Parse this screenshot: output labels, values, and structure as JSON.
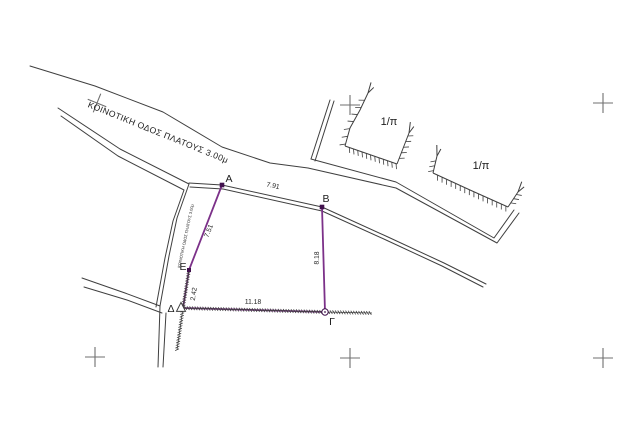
{
  "canvas": {
    "width": 640,
    "height": 429,
    "background": "#ffffff"
  },
  "colors": {
    "line": "#3f3f3f",
    "purple": "#7c3189",
    "marker": "#41124d",
    "grid": "#6f6f6f",
    "text": "#1c1c1c"
  },
  "parcel": {
    "vertex_labels": [
      "Α",
      "Β",
      "Γ",
      "Δ",
      "Ε"
    ],
    "side_lengths": {
      "ΑΒ": "7.91",
      "ΒΓ": "8.18",
      "ΓΔ": "11.18",
      "ΔΕ": "2.42",
      "ΕΑ": "7.51"
    },
    "road_name": "ΚΟΙΝΟΤΙΚΗ ΟΔΟΣ ΠΛΑΤΟΥΣ 3.00μ",
    "adjacent_parcel_label": "1/π"
  },
  "plan": {
    "crosshairs": [
      {
        "x": 97,
        "y": 103,
        "rotate": 22
      },
      {
        "x": 350,
        "y": 105,
        "rotate": 0
      },
      {
        "x": 603,
        "y": 103,
        "rotate": 0
      },
      {
        "x": 95,
        "y": 357,
        "rotate": 0
      },
      {
        "x": 350,
        "y": 358,
        "rotate": 0
      },
      {
        "x": 603,
        "y": 358,
        "rotate": 0
      }
    ],
    "polylines": [
      {
        "name": "top-road-upper-edge",
        "color": "line",
        "width": 1,
        "points": [
          [
            30,
            66
          ],
          [
            95,
            86
          ],
          [
            163,
            112
          ],
          [
            222,
            147
          ],
          [
            270,
            163
          ],
          [
            308,
            168
          ]
        ]
      },
      {
        "name": "neighbor-wall-bottom-outer",
        "color": "line",
        "width": 1,
        "points": [
          [
            308,
            168
          ],
          [
            396,
            188
          ],
          [
            497,
            243
          ],
          [
            519,
            213
          ]
        ]
      },
      {
        "name": "neighbor-wall-bottom-inner",
        "color": "line",
        "width": 1,
        "points": [
          [
            311,
            159
          ],
          [
            396,
            182
          ],
          [
            494,
            238
          ],
          [
            514,
            210
          ]
        ]
      },
      {
        "name": "neighbor-wall-left-a",
        "color": "line",
        "width": 1,
        "points": [
          [
            330,
            100
          ],
          [
            311,
            159
          ]
        ]
      },
      {
        "name": "neighbor-wall-left-b",
        "color": "line",
        "width": 1,
        "points": [
          [
            334,
            101
          ],
          [
            315,
            161
          ]
        ]
      },
      {
        "name": "road-edge-through-AB-a",
        "color": "line",
        "width": 1,
        "points": [
          [
            189,
            183
          ],
          [
            222,
            185
          ],
          [
            322,
            207
          ],
          [
            388,
            237
          ],
          [
            444,
            263
          ],
          [
            486,
            284
          ]
        ]
      },
      {
        "name": "road-edge-through-AB-b",
        "color": "line",
        "width": 1,
        "points": [
          [
            190,
            187
          ],
          [
            223,
            189
          ],
          [
            322,
            211
          ],
          [
            386,
            240
          ],
          [
            442,
            266
          ],
          [
            483,
            287
          ]
        ]
      },
      {
        "name": "west-road-edge-a",
        "color": "line",
        "width": 1,
        "points": [
          [
            58,
            108
          ],
          [
            120,
            149
          ],
          [
            189,
            184
          ],
          [
            177,
            218
          ],
          [
            169,
            256
          ],
          [
            160,
            306
          ]
        ]
      },
      {
        "name": "west-road-edge-b",
        "color": "line",
        "width": 1,
        "points": [
          [
            61,
            116
          ],
          [
            118,
            156
          ],
          [
            184,
            190
          ],
          [
            173,
            221
          ],
          [
            165,
            258
          ],
          [
            156,
            307
          ]
        ]
      },
      {
        "name": "southwest-road-edge-a",
        "color": "line",
        "width": 1,
        "points": [
          [
            82,
            278
          ],
          [
            125,
            293
          ],
          [
            160,
            306
          ]
        ]
      },
      {
        "name": "southwest-road-edge-b",
        "color": "line",
        "width": 1,
        "points": [
          [
            84,
            287
          ],
          [
            127,
            300
          ],
          [
            162,
            313
          ]
        ]
      },
      {
        "name": "south-road-edge-a",
        "color": "line",
        "width": 1,
        "points": [
          [
            160,
            306
          ],
          [
            158,
            367
          ]
        ]
      },
      {
        "name": "south-road-edge-b",
        "color": "line",
        "width": 1,
        "points": [
          [
            166,
            313
          ],
          [
            163,
            367
          ]
        ]
      },
      {
        "name": "parcel-edge-A-E",
        "color": "purple",
        "width": 1.8,
        "points": [
          [
            222,
            185
          ],
          [
            189,
            270
          ]
        ]
      },
      {
        "name": "parcel-edge-E-D",
        "color": "purple",
        "width": 1.8,
        "points": [
          [
            189,
            270
          ],
          [
            183,
            308
          ]
        ]
      },
      {
        "name": "parcel-edge-D-G",
        "color": "purple",
        "width": 1.8,
        "points": [
          [
            183,
            308
          ],
          [
            325,
            312
          ]
        ]
      },
      {
        "name": "parcel-edge-B-G",
        "color": "purple",
        "width": 1.8,
        "points": [
          [
            322,
            207
          ],
          [
            325,
            312
          ]
        ]
      }
    ],
    "hatches": [
      {
        "name": "fence-hatch-E-D-south",
        "color": "line",
        "width": 0.8,
        "mode": "cross",
        "spacing": 2.6,
        "len": 3.6,
        "points": [
          [
            189,
            270
          ],
          [
            183,
            308
          ],
          [
            177,
            350
          ]
        ]
      },
      {
        "name": "fence-hatch-D-G-east",
        "color": "line",
        "width": 0.8,
        "mode": "cross",
        "spacing": 2.6,
        "len": 3.6,
        "points": [
          [
            183,
            308
          ],
          [
            325,
            312
          ],
          [
            372,
            313
          ]
        ]
      },
      {
        "name": "slope-hatch-1-west",
        "color": "line",
        "width": 1,
        "mode": "side",
        "spacing": 8,
        "len": 5.5,
        "points": [
          [
            368,
            93
          ],
          [
            360,
            110
          ],
          [
            350,
            128
          ],
          [
            345,
            146
          ]
        ]
      },
      {
        "name": "slope-hatch-1-south",
        "color": "line",
        "width": 1,
        "mode": "side",
        "spacing": 4.5,
        "len": 5,
        "points": [
          [
            345,
            146
          ],
          [
            397,
            164
          ]
        ]
      },
      {
        "name": "slope-hatch-1-east",
        "color": "line",
        "width": 1,
        "mode": "side",
        "spacing": 6,
        "len": 5,
        "points": [
          [
            397,
            164
          ],
          [
            409,
            133
          ]
        ]
      },
      {
        "name": "slope-hatch-2-west",
        "color": "line",
        "width": 1,
        "mode": "side",
        "spacing": 5,
        "len": 5,
        "points": [
          [
            437,
            156
          ],
          [
            433,
            173
          ]
        ]
      },
      {
        "name": "slope-hatch-2-south",
        "color": "line",
        "width": 1,
        "mode": "side",
        "spacing": 5,
        "len": 5,
        "points": [
          [
            433,
            173
          ],
          [
            470,
            190
          ],
          [
            508,
            207
          ]
        ]
      },
      {
        "name": "slope-hatch-2-east",
        "color": "line",
        "width": 1,
        "mode": "side",
        "spacing": 5,
        "len": 5,
        "points": [
          [
            508,
            207
          ],
          [
            518,
            192
          ]
        ]
      }
    ],
    "forks": [
      {
        "name": "slope-arrow-1-west",
        "x": 368,
        "y": 93,
        "angle": -60
      },
      {
        "name": "slope-arrow-1-east",
        "x": 409,
        "y": 133,
        "angle": -69
      },
      {
        "name": "slope-arrow-2-west",
        "x": 437,
        "y": 156,
        "angle": -77
      },
      {
        "name": "slope-arrow-2-east",
        "x": 518,
        "y": 192,
        "angle": -56
      }
    ],
    "markers": [
      {
        "name": "vertex-point-A",
        "type": "square",
        "x": 222,
        "y": 185,
        "size": 4.6,
        "color": "marker"
      },
      {
        "name": "vertex-point-B",
        "type": "square",
        "x": 322,
        "y": 207,
        "size": 4.6,
        "color": "marker"
      },
      {
        "name": "vertex-point-G",
        "type": "circle",
        "x": 325,
        "y": 312,
        "r": 3.2,
        "color": "marker"
      },
      {
        "name": "vertex-point-D",
        "type": "triangle",
        "x": 181,
        "y": 308,
        "size": 9,
        "color": "line"
      },
      {
        "name": "vertex-point-E",
        "type": "square",
        "x": 189,
        "y": 270,
        "size": 4,
        "color": "marker"
      }
    ],
    "labels": [
      {
        "name": "road-name-top",
        "text": "ΚΟΙΝΟΤΙΚΗ  ΟΔΟΣ  ΠΛΑΤΟΥΣ  3.00μ",
        "x": 158,
        "y": 133,
        "size": 8.6,
        "rotate": 22,
        "ls": 0.4,
        "color": "text"
      },
      {
        "name": "road-name-west",
        "text": "ΚΟΙΝΟΤΙΚΗ ΟΔΟΣ ΠΛΑΤΟΥΣ 3.00μ",
        "x": 186,
        "y": 236,
        "size": 4,
        "rotate": -78,
        "ls": 0,
        "color": "text"
      },
      {
        "name": "parcel-label-1pi-west",
        "text": "1/π",
        "x": 389,
        "y": 122,
        "size": 11,
        "rotate": 0,
        "ls": 0,
        "color": "text"
      },
      {
        "name": "parcel-label-1pi-east",
        "text": "1/π",
        "x": 481,
        "y": 166,
        "size": 11,
        "rotate": 0,
        "ls": 0,
        "color": "text"
      },
      {
        "name": "vertex-label-A",
        "text": "Α",
        "x": 229,
        "y": 179,
        "size": 10.5,
        "rotate": 0,
        "ls": 0,
        "color": "text"
      },
      {
        "name": "vertex-label-B",
        "text": "Β",
        "x": 326,
        "y": 199,
        "size": 10.5,
        "rotate": 0,
        "ls": 0,
        "color": "text"
      },
      {
        "name": "vertex-label-G",
        "text": "Γ",
        "x": 332,
        "y": 322,
        "size": 10.5,
        "rotate": 0,
        "ls": 0,
        "color": "text"
      },
      {
        "name": "vertex-label-D",
        "text": "Δ",
        "x": 171,
        "y": 309,
        "size": 10.5,
        "rotate": 0,
        "ls": 0,
        "color": "text"
      },
      {
        "name": "vertex-label-E",
        "text": "Ε",
        "x": 183,
        "y": 267,
        "size": 10.5,
        "rotate": 0,
        "ls": 0,
        "color": "text"
      },
      {
        "name": "dim-AB",
        "text": "7.91",
        "x": 273,
        "y": 186,
        "size": 6.8,
        "rotate": 12,
        "ls": 0,
        "color": "text"
      },
      {
        "name": "dim-BG",
        "text": "8.18",
        "x": 317,
        "y": 258,
        "size": 6.8,
        "rotate": -89,
        "ls": 0,
        "color": "text"
      },
      {
        "name": "dim-DG",
        "text": "11.18",
        "x": 253,
        "y": 302,
        "size": 6.8,
        "rotate": 1.5,
        "ls": 0,
        "color": "text"
      },
      {
        "name": "dim-AE",
        "text": "7.51",
        "x": 209,
        "y": 231,
        "size": 6.8,
        "rotate": -69,
        "ls": 0,
        "color": "text"
      },
      {
        "name": "dim-ED",
        "text": "2.42",
        "x": 194,
        "y": 294,
        "size": 6.8,
        "rotate": -81,
        "ls": 0,
        "color": "text"
      }
    ]
  }
}
